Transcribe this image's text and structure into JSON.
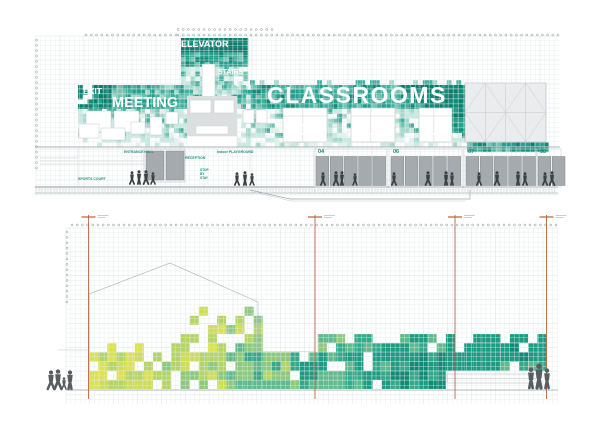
{
  "colors": {
    "background": "#ffffff",
    "grid": "#e3eaeb",
    "grid_major": "#d6e0e2",
    "accent_line": "#b2603c",
    "label_teal": "#1b8f7b",
    "door_gray": "#a4aaad",
    "door_stroke": "#82888b",
    "panel_gray": "#eaeced",
    "panel_line": "#c3c9cc",
    "outline_gray": "#b5bbbd",
    "ground_gray": "#8f9597",
    "figure_dark": "#3c4043",
    "figure_gray": "#585d60",
    "teal_palette": [
      "#0a7c6b",
      "#128977",
      "#23a08c",
      "#43b09e",
      "#74c4b4",
      "#a3d8cb",
      "#c9e8e0",
      "#e4f2ee"
    ],
    "lime_palette": [
      "#dce24d",
      "#cfdd55",
      "#b4d563",
      "#8cc97b",
      "#5fba8b",
      "#33a98a",
      "#1b9b81",
      "#108a74"
    ]
  },
  "top_elevation": {
    "labels": {
      "elevator": "ELEVATOR",
      "stairs": "STAIRS",
      "exit": "EXIT",
      "meeting": "MEETING",
      "classrooms": "CLASSROOMS"
    },
    "room_numbers": [
      "11",
      "12",
      "13"
    ],
    "door_numbers": [
      "04",
      "06",
      "07",
      "08"
    ],
    "small_labels": {
      "entrance_hall": "ENTRANCE HALL",
      "reception": "RECEPTION",
      "playground": "indoor PLAYGROUND",
      "sports_court": "SPORTS COURT",
      "stop_by_stay": [
        "STOP",
        "BY",
        "STAY"
      ]
    }
  },
  "bottom_elevation": {
    "description": "pixel mosaic elevation, lime to teal gradient"
  }
}
